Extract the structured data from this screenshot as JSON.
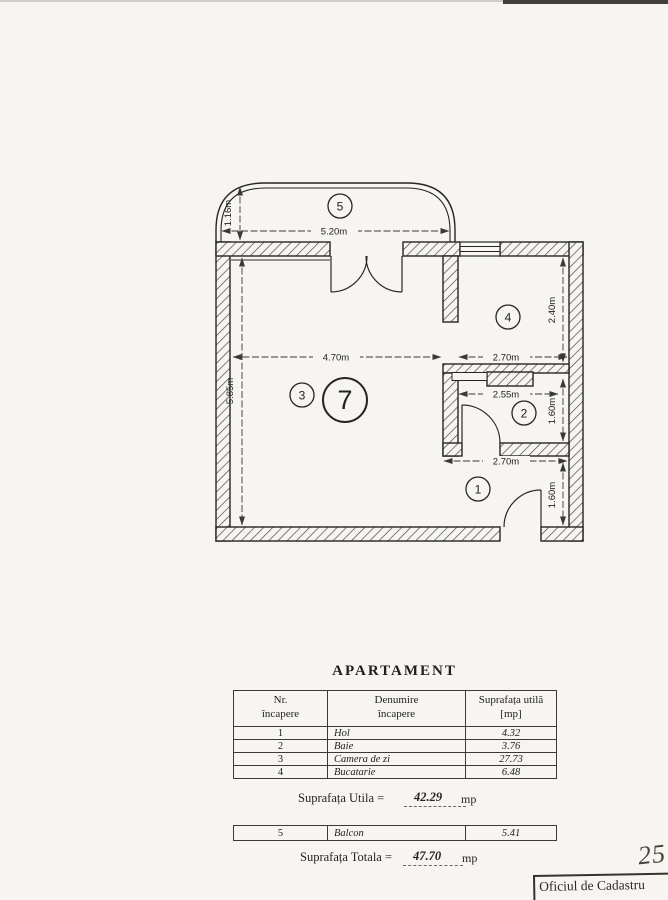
{
  "plan": {
    "rooms": {
      "balcony": "5",
      "kitchen": "4",
      "living": "3",
      "apartment_number": "7",
      "bathroom": "2",
      "hall": "1"
    },
    "dims": {
      "balcony_width": "5.20m",
      "balcony_depth": "1.16m",
      "living_width": "4.70m",
      "living_height": "5.85m",
      "kitchen_width": "2.70m",
      "kitchen_height": "2.40m",
      "bathroom_width": "2.55m",
      "bathroom_height": "1.60m",
      "hall_width": "2.70m",
      "hall_height": "1.60m"
    }
  },
  "table": {
    "title": "APARTAMENT",
    "header": {
      "col1_line1": "Nr.",
      "col1_line2": "încapere",
      "col2_line1": "Denumire",
      "col2_line2": "încapere",
      "col3_line1": "Suprafața utilă",
      "col3_line2": "[mp]"
    },
    "rows": [
      {
        "nr": "1",
        "name": "Hol",
        "area": "4.32"
      },
      {
        "nr": "2",
        "name": "Baie",
        "area": "3.76"
      },
      {
        "nr": "3",
        "name": "Camera de zi",
        "area": "27.73"
      },
      {
        "nr": "4",
        "name": "Bucatarie",
        "area": "6.48"
      }
    ],
    "utila": {
      "label": "Suprafața Utila =",
      "value": "42.29",
      "unit": "mp"
    },
    "balcony_row": {
      "nr": "5",
      "name": "Balcon",
      "area": "5.41"
    },
    "totala": {
      "label": "Suprafața Totala =",
      "value": "47.70",
      "unit": "mp"
    }
  },
  "footer": {
    "handwritten_number": "25",
    "stamp_text": "Oficiul de Cadastru"
  }
}
